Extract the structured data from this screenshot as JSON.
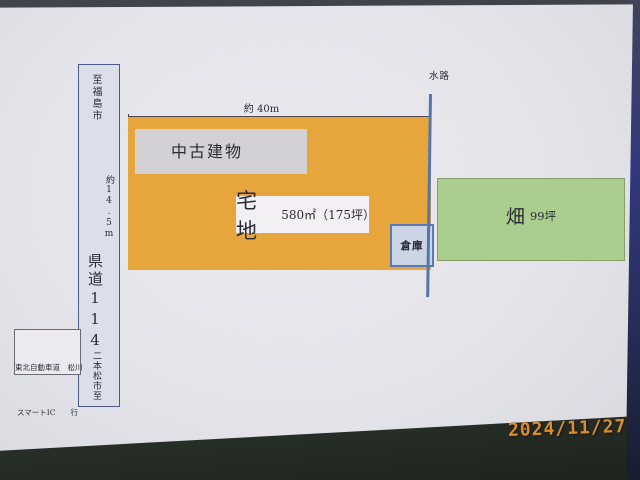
{
  "date_stamp": "2024/11/27",
  "road": {
    "to_north": "至福島市",
    "name": "県道114",
    "to_south": "二本松市至",
    "width_dim": "約14.5m"
  },
  "highway_note": {
    "line1": "東北自動車道　松川",
    "line2": "スマートIC　　行",
    "line3": "き"
  },
  "top_dim": "約 40m",
  "waterway_label": "水路",
  "parcel": {
    "building": "中古建物",
    "name": "宅地",
    "area": "580㎡（175坪）",
    "warehouse": "倉庫"
  },
  "field": {
    "name": "畑",
    "area": "99坪"
  },
  "colors": {
    "parcel": "#e7a63c",
    "field": "#abce8e",
    "waterway": "#5476af",
    "date": "#dd8c2b"
  }
}
